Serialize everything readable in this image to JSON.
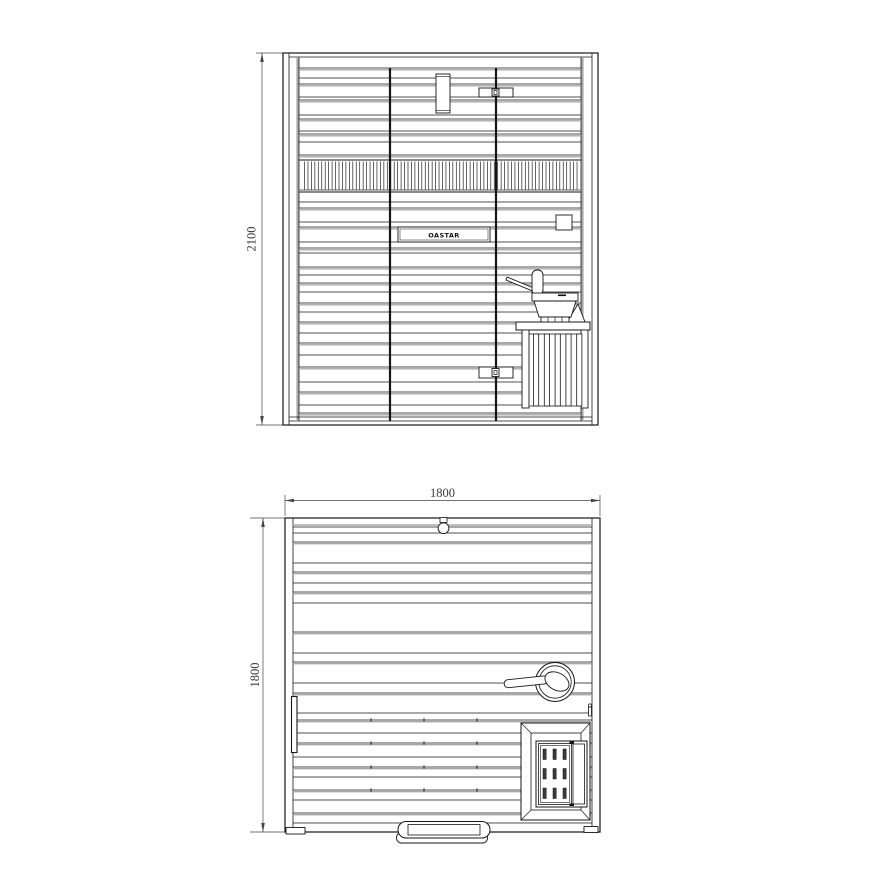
{
  "colors": {
    "background": "#ffffff",
    "line": "#161616",
    "shade": "#a8a8a8",
    "dim_line": "#444444",
    "text": "#3a3a3a"
  },
  "elevation_view": {
    "height_dimension": "2100",
    "logo_text": "OASTAR"
  },
  "plan_view": {
    "width_dimension": "1800",
    "depth_dimension": "1800"
  }
}
